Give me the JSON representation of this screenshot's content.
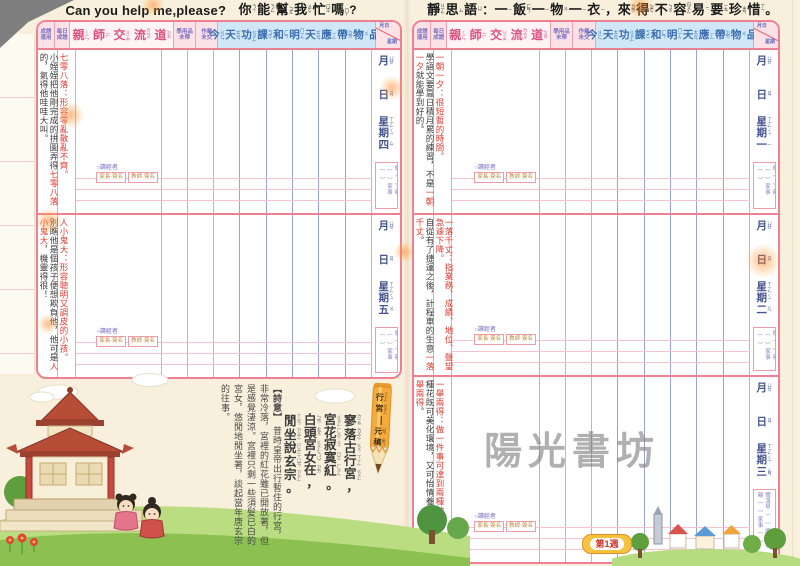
{
  "left_page": {
    "title_en": "Can you help me,please?",
    "title_zh": [
      [
        "你",
        "ㄋㄧˇ"
      ],
      [
        "能",
        "ㄋㄥˊ"
      ],
      [
        "幫",
        "ㄅㄤ"
      ],
      [
        "我",
        "ㄨㄛˇ"
      ],
      [
        "忙",
        "ㄇㄤˊ"
      ],
      [
        "嗎",
        "˙ㄇㄚ"
      ],
      [
        "?",
        ""
      ]
    ],
    "sections": [
      {
        "weekday": [
          [
            "星",
            "ㄒㄧㄥ"
          ],
          [
            "期",
            "ㄑㄧˊ"
          ],
          [
            "四",
            "ㄙˋ"
          ]
        ],
        "idiom": "七零八落：形容零亂散亂不齊。",
        "story": [
          {
            "t": "小姪姪把他剛完成的拼圖弄得"
          },
          {
            "t": "七零八落",
            "red": true
          },
          {
            "t": "的，氣得他哇哇大叫。"
          }
        ]
      },
      {
        "weekday": [
          [
            "星",
            "ㄒㄧㄥ"
          ],
          [
            "期",
            "ㄑㄧˊ"
          ],
          [
            "五",
            "ㄨˇ"
          ]
        ],
        "idiom": "人小鬼大：形容聰明又調皮的小孩。",
        "story": [
          {
            "t": "別瞧他是個孩子便想欺負他，他可是"
          },
          {
            "t": "人小鬼大",
            "red": true
          },
          {
            "t": "，機靈得很！"
          }
        ]
      }
    ]
  },
  "right_page": {
    "jingsi": [
      [
        "靜",
        "ㄐㄧㄥˋ"
      ],
      [
        "思",
        "ㄙ"
      ],
      [
        "語",
        "ㄩˇ"
      ],
      [
        "：",
        ""
      ],
      [
        "一",
        "ㄧ"
      ],
      [
        "飯",
        "ㄈㄢˋ"
      ],
      [
        "一",
        "ㄧ"
      ],
      [
        "物",
        "ㄨˋ"
      ],
      [
        "一",
        "ㄧ"
      ],
      [
        "衣",
        "ㄧ"
      ],
      [
        "，",
        ""
      ],
      [
        "來",
        "ㄌㄞˊ"
      ],
      [
        "得",
        "ㄉㄜˊ"
      ],
      [
        "不",
        "ㄅㄨˋ"
      ],
      [
        "容",
        "ㄖㄨㄥˊ"
      ],
      [
        "易",
        "ㄧˋ"
      ],
      [
        "要",
        "ㄧㄠˋ"
      ],
      [
        "珍",
        "ㄓㄣ"
      ],
      [
        "惜",
        "ㄒㄧˊ"
      ],
      [
        "。",
        ""
      ]
    ],
    "sections": [
      {
        "weekday": [
          [
            "星",
            "ㄒㄧㄥ"
          ],
          [
            "期",
            "ㄑㄧˊ"
          ],
          [
            "一",
            "ㄧ"
          ]
        ],
        "idiom": "一朝一夕：很短暫的時間。",
        "story": [
          {
            "t": "學語文要靠日積月累的練習，不是"
          },
          {
            "t": "一朝一夕",
            "red": true
          },
          {
            "t": "就能學到好的。"
          }
        ]
      },
      {
        "weekday": [
          [
            "星",
            "ㄒㄧㄥ"
          ],
          [
            "期",
            "ㄑㄧˊ"
          ],
          [
            "二",
            "ㄦˋ"
          ]
        ],
        "idiom": "一落千丈：指業務、成績、地位、聲望急遽下降。",
        "story": [
          {
            "t": "自從有了捷運之後，計程車的生意"
          },
          {
            "t": "一落千丈",
            "red": true
          },
          {
            "t": "。"
          }
        ]
      },
      {
        "weekday": [
          [
            "星",
            "ㄒㄧㄥ"
          ],
          [
            "期",
            "ㄑㄧˊ"
          ],
          [
            "三",
            "ㄙㄢ"
          ]
        ],
        "idiom": "一舉兩得：做一件事可達到兩種效果。",
        "story": [
          {
            "t": "種花既可美化環境，又可怡情養性，真是"
          },
          {
            "t": "一舉兩得",
            "red": true
          },
          {
            "t": "。"
          }
        ]
      }
    ]
  },
  "table_headers": {
    "chengyu_yunyong": [
      "成語",
      "運用"
    ],
    "meiri_chengyu": [
      "每日",
      "成語"
    ],
    "qinshi": [
      [
        "親",
        "ㄑㄧㄣ"
      ],
      [
        "師",
        "ㄕ"
      ],
      [
        "交",
        "ㄐㄧㄠ"
      ],
      [
        "流",
        "ㄌㄧㄡˊ"
      ],
      [
        "道",
        "ㄉㄠˋ"
      ]
    ],
    "xueyongpin": [
      "學用品",
      "未帶"
    ],
    "zuoye": [
      "作業",
      "未交"
    ],
    "homework": [
      [
        "今",
        "ㄐㄧㄣ"
      ],
      [
        "天",
        "ㄊㄧㄢ"
      ],
      [
        "功",
        "ㄍㄨㄥ"
      ],
      [
        "課",
        "ㄎㄜˋ"
      ],
      [
        "和",
        "ㄏㄢˋ"
      ],
      [
        "明",
        "ㄇㄧㄥˊ"
      ],
      [
        "天",
        "ㄊㄧㄢ"
      ],
      [
        "應",
        "ㄧㄥ"
      ],
      [
        "帶",
        "ㄉㄞˋ"
      ],
      [
        "物",
        "ㄨˋ"
      ],
      [
        "品",
        "ㄆㄧㄣˇ"
      ]
    ],
    "date_diag_top": "月日",
    "date_diag_bottom": "星期"
  },
  "date_labels": {
    "month": [
      [
        "月",
        "ㄩㄝˋ"
      ]
    ],
    "day": [
      [
        "日",
        "ㄖˋ"
      ]
    ]
  },
  "daily_checks": {
    "temp_box": "體溫早（　）晚（　）親（　）家事（　）",
    "reader_label": "○讀經者",
    "sign_boxes": [
      "家長·簽名",
      "教師·簽名"
    ]
  },
  "poem": {
    "pencil_title": [
      [
        "行",
        "ㄒㄧㄥˊ"
      ],
      [
        "宮",
        "ㄍㄨㄥ"
      ]
    ],
    "pencil_author": [
      [
        "元",
        "ㄩㄢˊ"
      ],
      [
        "稹",
        "ㄓㄣˇ"
      ]
    ],
    "lines": [
      [
        [
          "寥",
          "ㄌㄧㄠˊ"
        ],
        [
          "落",
          "ㄌㄨㄛˋ"
        ],
        [
          "古",
          "ㄍㄨˇ"
        ],
        [
          "行",
          "ㄒㄧㄥˊ"
        ],
        [
          "宮",
          "ㄍㄨㄥ"
        ],
        [
          "，",
          ""
        ]
      ],
      [
        [
          "宮",
          "ㄍㄨㄥ"
        ],
        [
          "花",
          "ㄏㄨㄚ"
        ],
        [
          "寂",
          "ㄐㄧˊ"
        ],
        [
          "寞",
          "ㄇㄛˋ"
        ],
        [
          "紅",
          "ㄏㄨㄥˊ"
        ],
        [
          "。",
          ""
        ]
      ],
      [
        [
          "白",
          "ㄅㄞˊ"
        ],
        [
          "頭",
          "ㄊㄡˊ"
        ],
        [
          "宮",
          "ㄍㄨㄥ"
        ],
        [
          "女",
          "ㄋㄩˇ"
        ],
        [
          "在",
          "ㄗㄞˋ"
        ],
        [
          "，",
          ""
        ]
      ],
      [
        [
          "閒",
          "ㄒㄧㄢˊ"
        ],
        [
          "坐",
          "ㄗㄨㄛˋ"
        ],
        [
          "說",
          "ㄕㄨㄛ"
        ],
        [
          "玄",
          "ㄒㄩㄢˊ"
        ],
        [
          "宗",
          "ㄗㄨㄥ"
        ],
        [
          "。",
          ""
        ]
      ]
    ],
    "shiyi_header": "【詩意】",
    "shiyi": "昔時皇帝出行暫住的行宮，非常冷落，宮裡的紅花雖已開放著，但是感覺淒涼。宮裡只剩一些須髮已白的宮女，悠閒地閒坐著，談起當年唐玄宗的往事。"
  },
  "watermark": "陽光書坊",
  "week_badge": "第1週",
  "colors": {
    "table_border": "#ee8093",
    "header_pink_text": "#e0517f",
    "homework_header_bg": "#cfe7f6",
    "homework_header_text": "#3a6db0",
    "subcolumn_line": "#9aa4d1",
    "idiom_red": "#e03a2f",
    "date_text": "#44548e",
    "badge_text": "#d62f23",
    "badge_bg": "#f7c33f",
    "watermark_gray": "#707070"
  }
}
